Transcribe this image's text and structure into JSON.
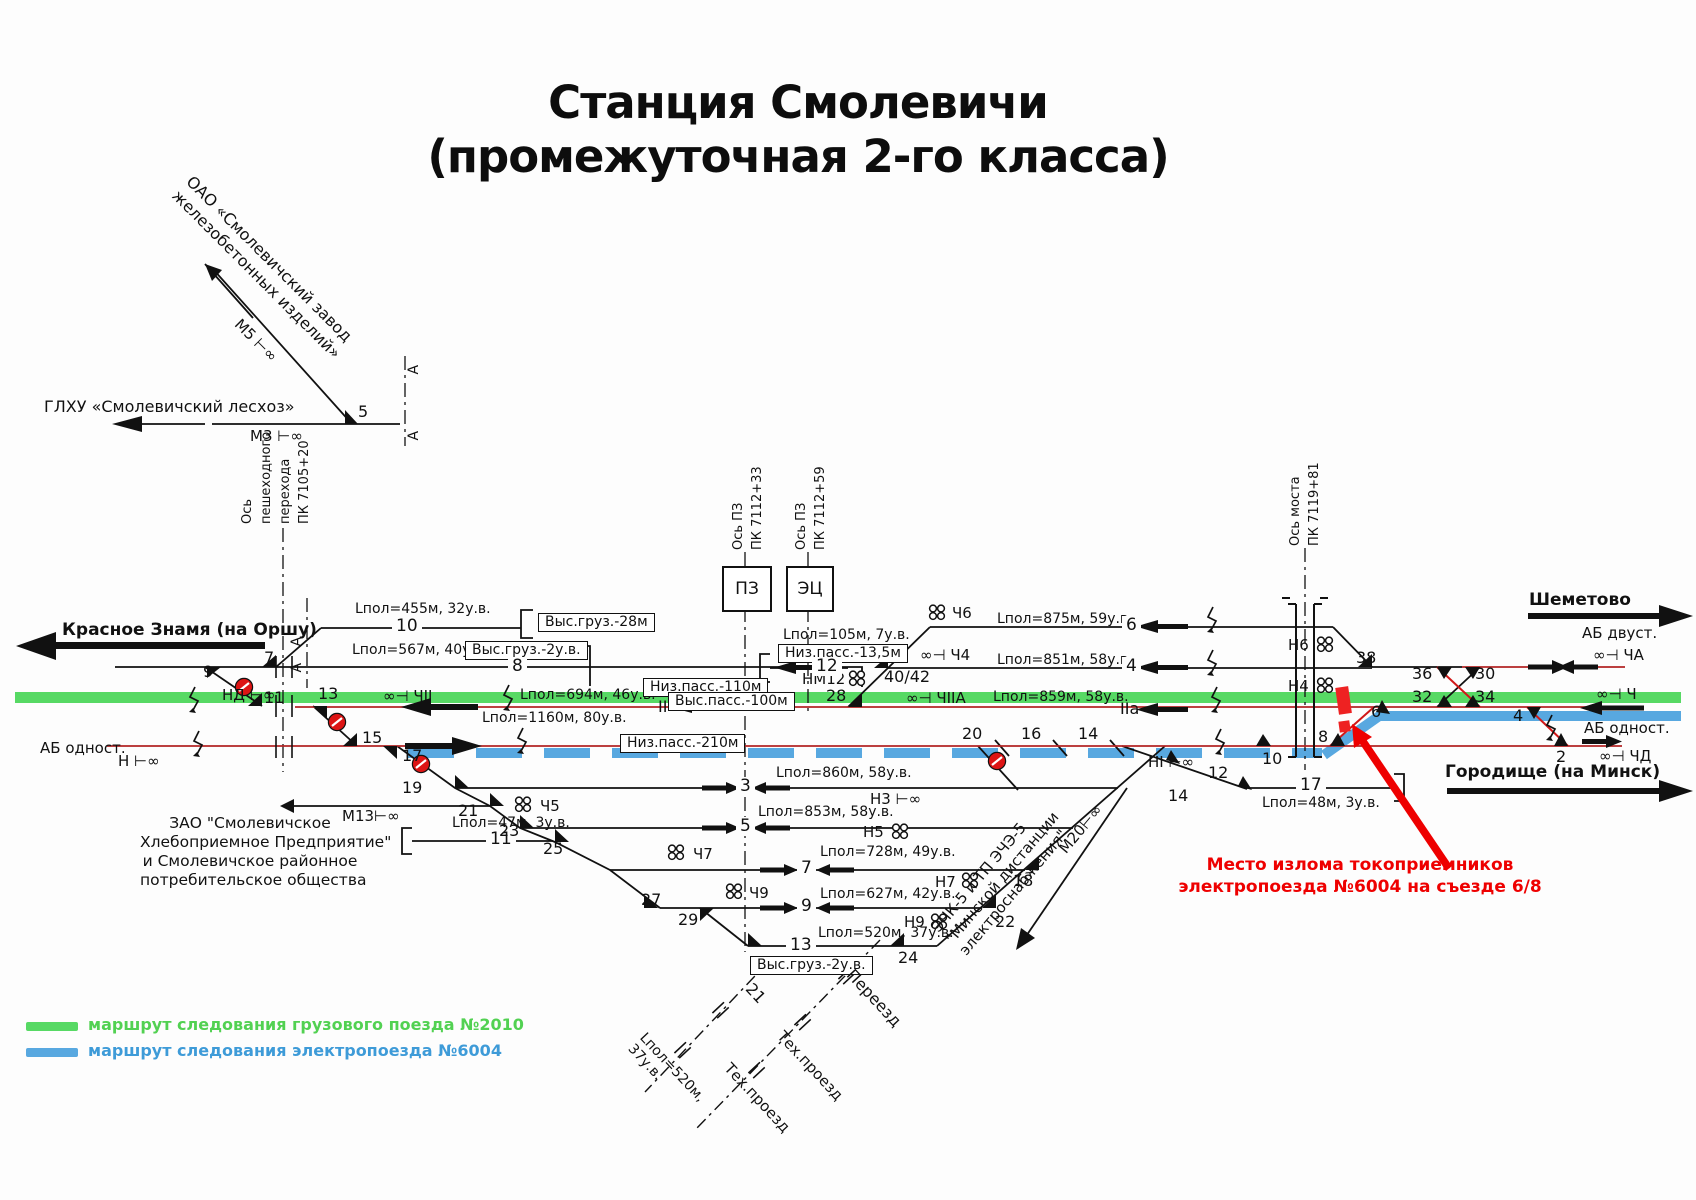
{
  "title": {
    "line1": "Станция Смолевичи",
    "line2": "(промежуточная 2-го класса)"
  },
  "corner": {
    "factory_l1": "ОАО «Смолевичский завод",
    "factory_l2": "железобетонных изделий»",
    "m5": "М5 ⊢∞",
    "leshoz": "ГЛХУ «Смолевичский лесхоз»",
    "m3": "М3 ⊢∞",
    "p5": "5",
    "a": "А"
  },
  "axes": {
    "ped": {
      "l1": "Ось",
      "l2": "пешеходного",
      "l3": "перехода",
      "l4": "ПК 7105+20"
    },
    "pz1": {
      "l1": "Ось ПЗ",
      "l2": "ПК 7112+33"
    },
    "pz2": {
      "l1": "Ось ПЗ",
      "l2": "ПК 7112+59"
    },
    "bridge": {
      "l1": "Ось моста",
      "l2": "ПК 7119+81"
    }
  },
  "posts": {
    "pz": "ПЗ",
    "ec": "ЭЦ"
  },
  "dest": {
    "west": "Красное Знамя (на Оршу)",
    "east_top": "Шеметово",
    "east_bottom": "Городище (на Минск)"
  },
  "blocks": {
    "ab2": "АБ двуст.",
    "ab1e": "АБ одност.",
    "ab1w": "АБ одност."
  },
  "signals": {
    "nd": "НД ⊢∞",
    "n": "Н ⊢∞",
    "ni": "НІ ⊢∞",
    "n3": "Н3 ⊢∞",
    "ch2": "∞⊣ ЧII",
    "ch2a": "∞⊣ ЧIIА",
    "ch4": "∞⊣ Ч4",
    "ch6": "Ч6",
    "cha": "∞⊣ ЧА",
    "ch": "∞⊣ Ч",
    "chd": "∞⊣ ЧД",
    "nm12": "НМ12",
    "n6": "Н6",
    "n4": "Н4",
    "ch5": "Ч5",
    "ch7": "Ч7",
    "ch9": "Ч9",
    "n5": "Н5",
    "n7": "Н7",
    "n9": "Н9"
  },
  "specs": {
    "t10": "Lпол=455м, 32у.в.",
    "t8": "Lпол=567м, 40у.в.",
    "t12": "Lпол=105м, 7у.в.",
    "main2": "Lпол=694м, 46у.в.",
    "main1": "Lпол=1160м, 80у.в.",
    "t6": "Lпол=875м, 59у.в.",
    "t4": "Lпол=851м, 58у.в.",
    "t2a": "Lпол=859м, 58у.в.",
    "t3": "Lпол=860м, 58у.в.",
    "t5": "Lпол=853м, 58у.в.",
    "t7": "Lпол=728м, 49у.в.",
    "t9": "Lпол=627м, 42у.в.",
    "t13": "Lпол=520м, 37у.в.",
    "t11": "Lпол=47м, 3у.в.",
    "t17": "Lпол=48м, 3у.в.",
    "road_l1": "Lпол=520м,",
    "road_l2": "37у.в."
  },
  "platforms": {
    "vg28": "Выс.груз.-28м",
    "vg2a": "Выс.груз.-2у.в.",
    "np110": "Низ.пасс.-110м",
    "vp100": "Выс.пасс.-100м",
    "np135": "Низ.пасс.-13,5м",
    "np210": "Низ.пасс.-210м",
    "vg2b": "Выс.груз.-2у.в."
  },
  "tracks": {
    "n10": "10",
    "n8": "8",
    "n12": "12",
    "n6": "6",
    "n4": "4",
    "m2": "II",
    "m2a": "IIа",
    "n40": "40/42",
    "n3": "3",
    "n5": "5",
    "n7": "7",
    "n9": "9",
    "n13": "13",
    "n11": "11",
    "n17": "17"
  },
  "points": {
    "p2": "2",
    "p4": "4",
    "p6": "6",
    "p7": "7",
    "p8": "8",
    "p9": "9",
    "p10": "10",
    "p11": "11",
    "p12": "12",
    "p13": "13",
    "p14": "14",
    "p14b": "14",
    "p15": "15",
    "p16": "16",
    "p17": "17",
    "p18": "18",
    "p19": "19",
    "p20": "20",
    "p21": "21",
    "p22": "22",
    "p23": "23",
    "p24": "24",
    "p25": "25",
    "p27": "27",
    "p28": "28",
    "p29": "29",
    "p30": "30",
    "p32": "32",
    "p34": "34",
    "p36": "36",
    "p38": "38",
    "road21": "21"
  },
  "spurs": {
    "m13": "М13⊢∞",
    "m20": "М20⊢∞"
  },
  "enterprise": {
    "l1": "ЗАО \"Смолевичское",
    "l2": "Хлебоприемное Предприятие\"",
    "l3": "и Смолевичское районное",
    "l4": "потребительское общества"
  },
  "power": {
    "l1": "ЭЧК-5 и ТП ЭЧЭ-5",
    "l2": "\"Минской дистанции",
    "l3": "электроснабжения\""
  },
  "roads": {
    "crossing": "Переезд",
    "tech1": "Тех.проезд",
    "tech2": "Тех.проезд"
  },
  "annotation": {
    "l1": "Место излома токоприемников",
    "l2": "электропоезда №6004 на съезде 6/8"
  },
  "legend": {
    "freight": "маршрут следования грузового поезда №2010",
    "electric": "маршрут следования электропоезда №6004"
  },
  "colors": {
    "freight_route": "#57D964",
    "electric_route": "#58A8E0",
    "alert": "#EE0000",
    "track_red": "#B32424"
  }
}
